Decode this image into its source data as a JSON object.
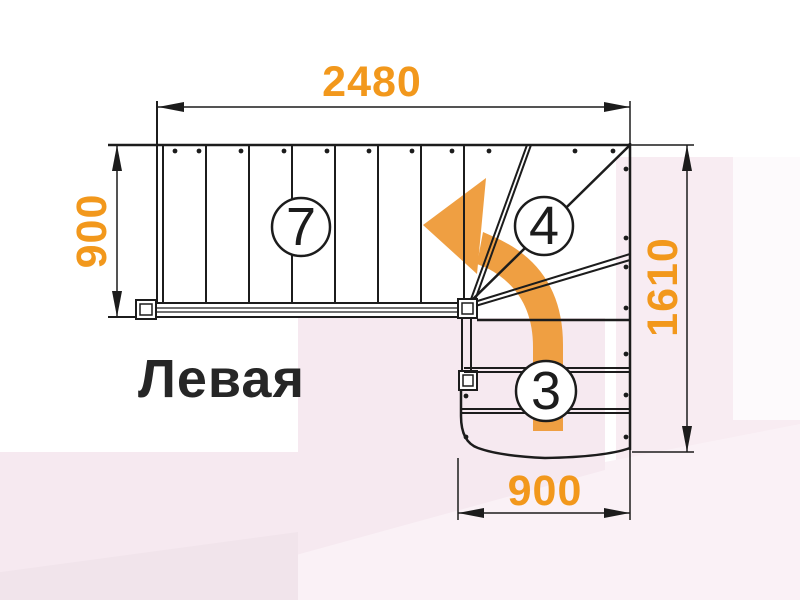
{
  "drawing": {
    "title_label": "Левая",
    "dimensions": {
      "top_width": "2480",
      "left_depth": "900",
      "right_height": "1610",
      "bottom_width": "900"
    },
    "step_counts": {
      "upper_flight": "7",
      "winder": "4",
      "lower_flight": "3"
    }
  },
  "colors": {
    "dimension_text_orange": "#F2981C",
    "direction_arrow_orange": "#EF9F42",
    "line_black": "#1C1C1C",
    "background_pink": "#F6E9F0",
    "background_pink_light": "#F8ECF2"
  }
}
